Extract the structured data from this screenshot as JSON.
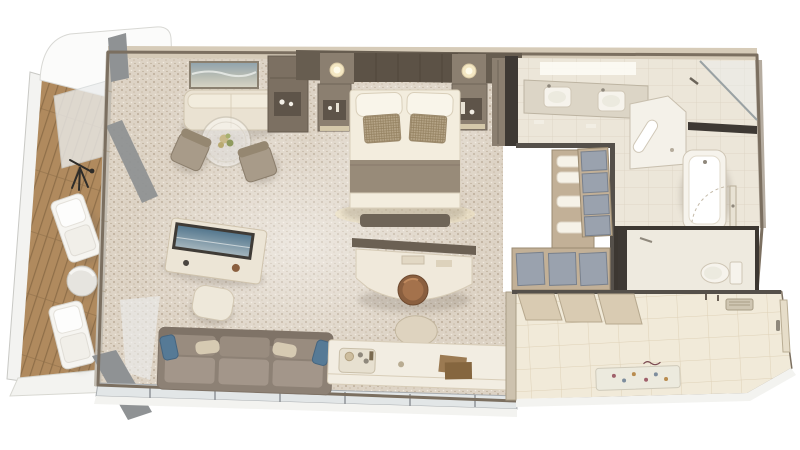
{
  "scene": {
    "title": "Top-down 3D rendering of a suite floor plan",
    "background": "#ffffff",
    "rooms": [
      {
        "id": "balcony",
        "label": "Private veranda",
        "furniture": [
          "awning",
          "wood deck",
          "glass railing",
          "lounge chair",
          "lounge chair",
          "round side table",
          "telescope",
          "open glass doors"
        ]
      },
      {
        "id": "living-room",
        "label": "Living and dining area",
        "furniture": [
          "seascape wall art",
          "banquette settee",
          "round glass dining table",
          "flower centerpiece",
          "dining chair",
          "dining chair",
          "bar cabinet",
          "tv console",
          "television",
          "ottoman",
          "three-seat sofa",
          "blue accent pillows",
          "writing desk",
          "round leather stool",
          "console bar table",
          "drinks tray",
          "books",
          "rounded lounge chair"
        ]
      },
      {
        "id": "bedroom",
        "label": "Bedroom",
        "furniture": [
          "paneled headboard wall",
          "wall sconce",
          "wall sconce",
          "nightstand",
          "nightstand",
          "king bed",
          "white pillows",
          "woven accent pillows",
          "foot throw",
          "foot bench",
          "wardrobe"
        ]
      },
      {
        "id": "walk-in-closet",
        "label": "Walk-in closet",
        "furniture": [
          "towel shelves",
          "storage box column",
          "storage box row"
        ]
      },
      {
        "id": "bathroom",
        "label": "Bathroom",
        "furniture": [
          "double-sink vanity",
          "ceiling light panel",
          "walk-in shower",
          "shower bench",
          "grab bar",
          "bathtub",
          "bathroom door",
          "dark ledge"
        ]
      },
      {
        "id": "wc",
        "label": "Water closet",
        "furniture": [
          "toilet",
          "glass door frame"
        ]
      },
      {
        "id": "entry-hall",
        "label": "Entry hall",
        "furniture": [
          "sliding closet doors",
          "air vent",
          "coat hooks",
          "entry door",
          "patterned doormat",
          "marble tile floor"
        ]
      }
    ],
    "palette": {
      "carpet": "#ddd3c5",
      "carpetDotA": "#b2a28c",
      "carpetDotB": "#c9bba7",
      "carpetDotC": "#f0e9de",
      "wallLight": "#d6cbb8",
      "wallBand": "#b5aca0",
      "wallDark": "#55504a",
      "wallCharcoal": "#3e3934",
      "perimeter": "#7b6f60",
      "thinLine": "#b3a894",
      "headboard": "#675d50",
      "headboardPanel": "#5c5246",
      "nicheDark": "#5e5449",
      "taupe": "#8b7f70",
      "taupeDark": "#6f6458",
      "linen": "#f3edde",
      "linenShadow": "#d9cfba",
      "pillowWhite": "#f9f5ea",
      "accentPillow": "#b6a588",
      "accentPillowLine": "#9c8a6d",
      "weaveLine": "#93805f",
      "throw": "#988b79",
      "benchDark": "#6e6457",
      "sofa": "#8d8175",
      "sofaDark": "#7f7367",
      "sofaCushion": "#998c7f",
      "sofaSeat": "#a3968a",
      "pillowBlue": "#567a96",
      "pillowBlueDark": "#46657f",
      "pillowBeige": "#d6cab2",
      "cream": "#ece5d6",
      "creamLine": "#cfc3ad",
      "fixture": "#f6f3ec",
      "fixtureLine": "#cfc6b5",
      "tvFrame": "#3f3b36",
      "tvSky": "#55788f",
      "tvSea": "#a3b4bc",
      "artFrame": "#8a8070",
      "artSky": "#8fa2ac",
      "artSand": "#d9d6c6",
      "glass": "#e2e6e7",
      "glassFrame": "#a9adb0",
      "glassLight": "#eceeee",
      "doorPanel": "#8f9294",
      "sill": "#f3f3f0",
      "railing": "#f3f3f1",
      "railingLine": "#c9c9c5",
      "deckWood": "#b08a5e",
      "deckWoodLine": "#8f6f49",
      "cabinet": "#7c7062",
      "cabinetDark": "#665b4f",
      "deskPartition": "#6b6053",
      "stoolSeat": "#8a5f3f",
      "stoolDark": "#6e4a30",
      "shelfWood": "#c2b097",
      "shelfLine": "#9a8a70",
      "boxGray": "#9aa2ae",
      "boxLine": "#79818d",
      "towel": "#f6f2e8",
      "counter": "#dcd5c6",
      "counterLine": "#bdb4a2",
      "bathFloor": "#ece6d9",
      "bathLine": "#dbd2c2",
      "marble": "#f1ead9",
      "marbleLine": "#ded1b8",
      "closetDoor": "#d9cbb2",
      "closetDoorLine": "#b6a88e",
      "mat": "#eceade",
      "matLine": "#cfcaba",
      "matDotA": "#a0616b",
      "matDotB": "#7d8d9d",
      "matDotC": "#b98c4f",
      "chair": "#a89b89",
      "chairDark": "#8b7e6c",
      "chairBack": "#958771",
      "book1": "#9b7a52",
      "book2": "#85663f",
      "metal": "#8f887c",
      "glow": "#f4e7c3"
    }
  }
}
